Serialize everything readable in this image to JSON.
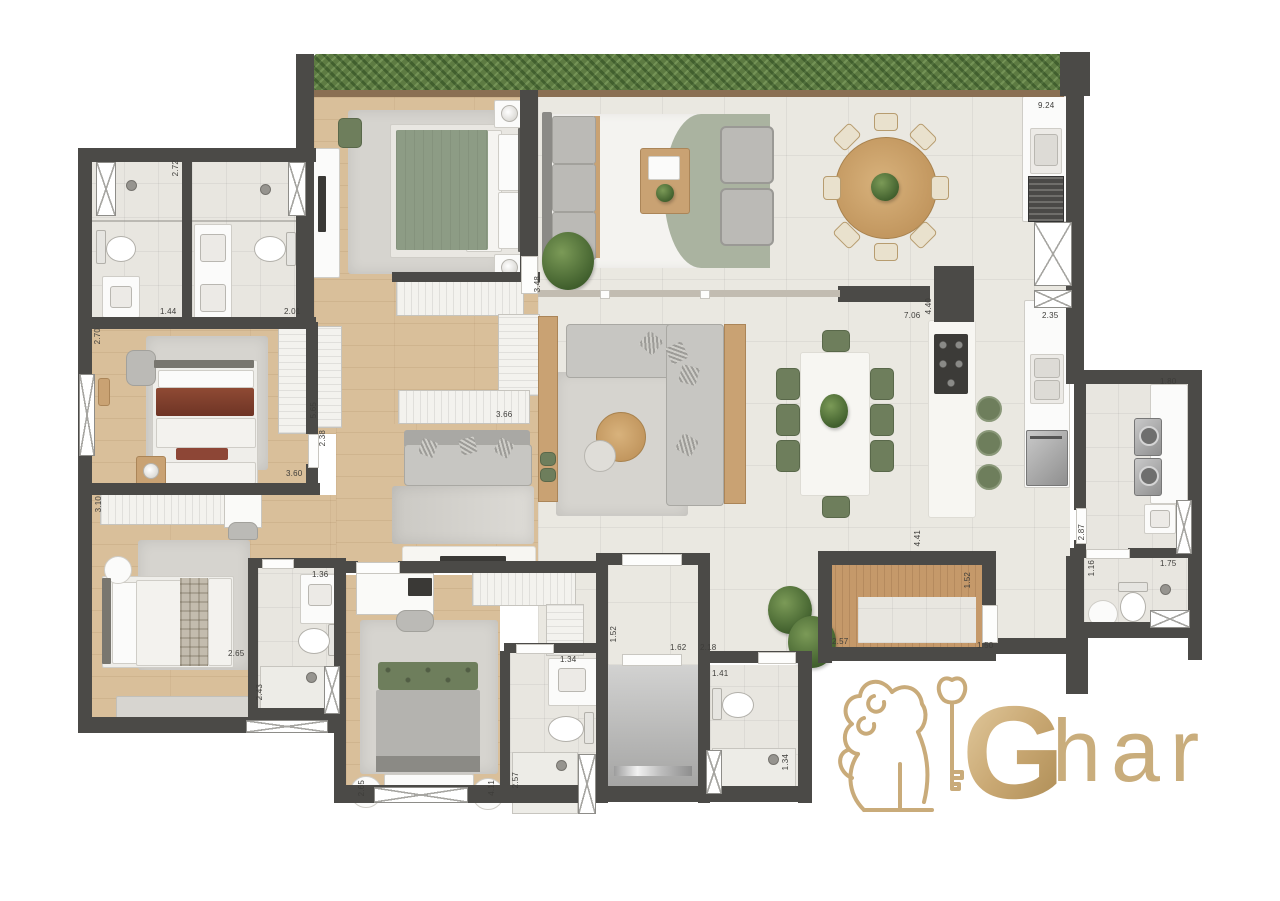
{
  "brand": {
    "name": "Ghar",
    "initial": "G",
    "rest": "har"
  },
  "colors": {
    "wall": "#4b4a47",
    "wood_floor": "#d9bf9a",
    "tile_floor": "#eae8e1",
    "bath_floor": "#e8e6e0",
    "hedge_green": "#5d7b42",
    "sage_green": "#8d9c85",
    "chair_green": "#6e7e5c",
    "marble": "#f7f6f2",
    "gold": "#c9ab7a"
  },
  "dims": [
    "2.72",
    "1.44",
    "2.01",
    "2.70",
    "5.65",
    "2.38",
    "3.60",
    "3.10",
    "2.65",
    "1.36",
    "2.43",
    "3.66",
    "3.48",
    "9.24",
    "7.06",
    "4.40",
    "2.35",
    "1.80",
    "2.87",
    "1.16",
    "1.75",
    "4.41",
    "1.52",
    "2.57",
    "1.50",
    "1.52",
    "1.62",
    "2.18",
    "1.41",
    "1.34",
    "2.65",
    "4.11",
    "2.57",
    "1.34"
  ]
}
